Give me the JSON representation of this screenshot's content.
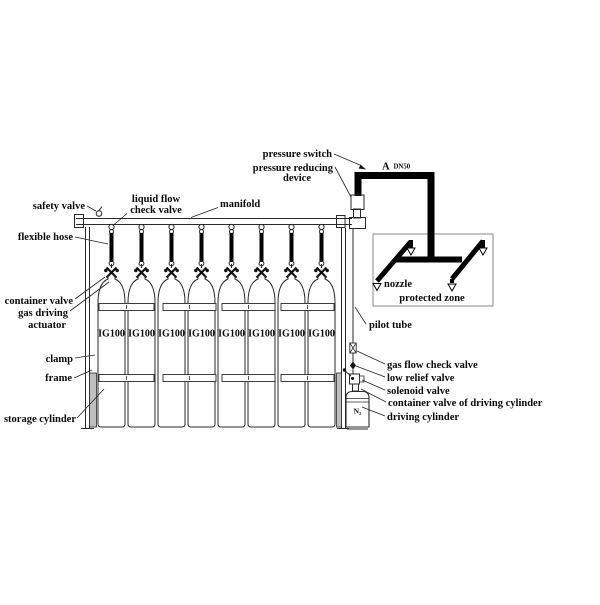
{
  "diagram": {
    "left_labels": {
      "safety_valve": "safety valve",
      "liquid_flow_line1": "liquid flow",
      "liquid_flow_line2": "check valve",
      "manifold": "manifold",
      "flexible_hose": "flexible hose",
      "container_valve": "container valve",
      "gas_driving": "gas driving",
      "actuator": "actuator",
      "clamp": "clamp",
      "frame": "frame",
      "storage_cylinder": "storage cylinder"
    },
    "right_labels": {
      "pressure_switch": "pressure switch",
      "pressure_reducing_line1": "pressure reducing",
      "pressure_reducing_line2": "device",
      "pilot_tube": "pilot tube",
      "gas_flow_check_valve": "gas flow check valve",
      "low_relief_valve": "low relief valve",
      "solenoid_valve": "solenoid valve",
      "container_valve_of_driving_cylinder": "container valve of driving cylinder",
      "driving_cylinder": "driving cylinder"
    },
    "zone_labels": {
      "nozzle": "nozzle",
      "protected_zone": "protected zone"
    },
    "pipe_marker": {
      "letter": "A",
      "size": "DN50"
    },
    "driving_cylinder_content": "N₂",
    "cylinders": {
      "count": 8,
      "labels": [
        "IG100",
        "IG100",
        "IG100",
        "IG100",
        "IG100",
        "IG100",
        "IG100",
        "IG100"
      ]
    },
    "colors": {
      "line": "#2a2a2a",
      "pipe": "#000000",
      "zone_border": "#8a8a8a",
      "frame_fill": "#bfbfbf"
    }
  }
}
